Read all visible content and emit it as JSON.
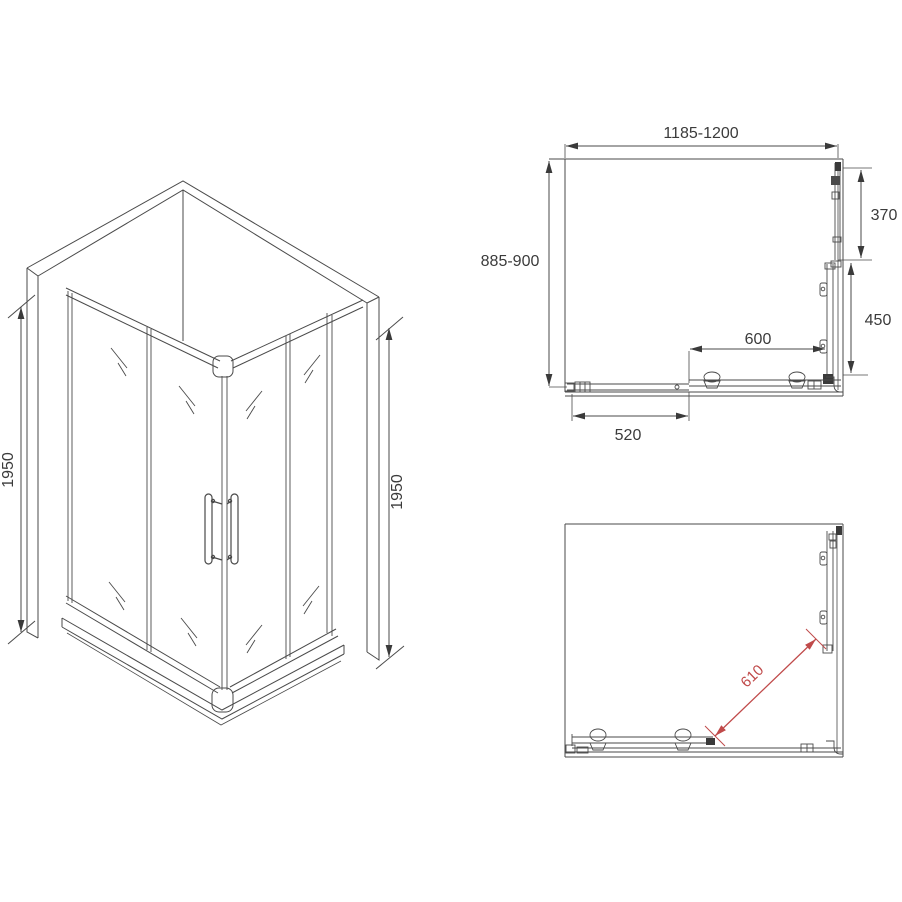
{
  "figure": {
    "type": "technical-drawing",
    "subject": "corner shower enclosure with sliding doors",
    "colors": {
      "line": "#4a4a4a",
      "text": "#3b3b3b",
      "accent_red": "#c04a4a",
      "background": "#ffffff"
    }
  },
  "iso_view": {
    "height_left": "1950",
    "height_right": "1950"
  },
  "plan_top": {
    "width": "1185-1200",
    "depth": "885-900",
    "side_fixed_panel": "370",
    "side_door_opening": "450",
    "front_door_opening": "600",
    "front_door_panel": "520"
  },
  "plan_bottom": {
    "diagonal_opening": "610"
  }
}
